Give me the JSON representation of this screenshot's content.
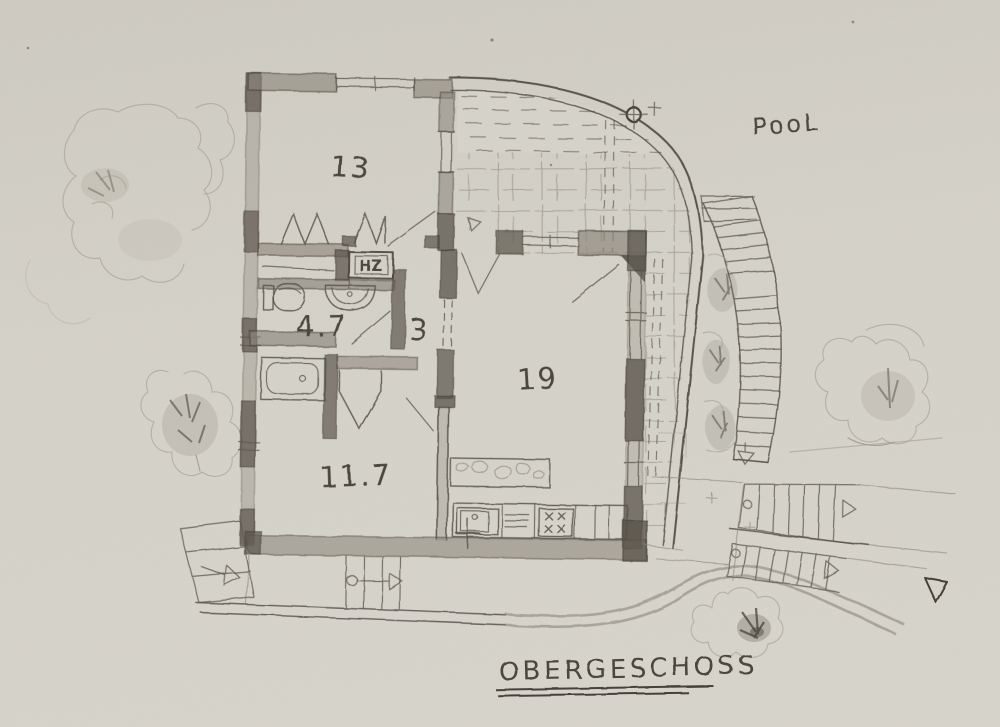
{
  "title": {
    "text": "OBERGESCHOSS"
  },
  "site": {
    "pool_label": "PooL"
  },
  "rooms": [
    {
      "id": "room-13",
      "label": "13"
    },
    {
      "id": "bathroom",
      "label": "4.7"
    },
    {
      "id": "hallway",
      "label": "3"
    },
    {
      "id": "living-kitchen",
      "label": "19"
    },
    {
      "id": "room-11-7",
      "label": "11.7"
    }
  ],
  "fixtures": {
    "heating_label": "HZ"
  },
  "colors": {
    "paper": "#d5d2c9",
    "pencil_dark": "#4b463e",
    "pencil_mid": "#6e6860",
    "pencil_light": "#a7a195",
    "wall_shade": "#8a8479"
  }
}
